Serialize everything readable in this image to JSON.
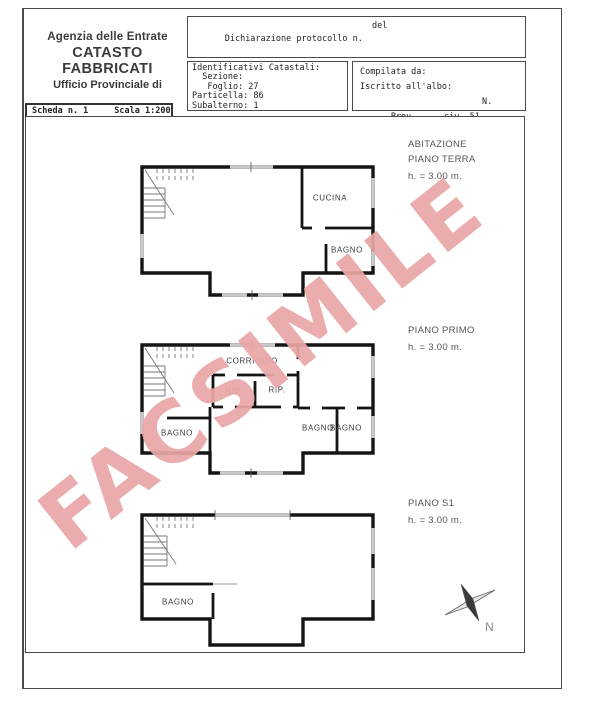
{
  "header": {
    "line1": "Agenzia delle Entrate",
    "line2": "CATASTO FABBRICATI",
    "line3": "Ufficio Provinciale di"
  },
  "protocol_box": {
    "declaration_label": "Dichiarazione protocollo n.",
    "del_label": "del",
    "planimetria_label": "Planimetria di u.i.u. in Comune di",
    "street": "Via Voghera",
    "civic": "civ. 51"
  },
  "cadastral_box": {
    "title": "Identificativi Catastali:",
    "rows": [
      "  Sezione:",
      "   Foglio: 27",
      "Particella: 86",
      "Subalterno: 1"
    ]
  },
  "compiler_box": {
    "compiled_by": "Compilata da:",
    "registered": "Iscritto all'albo:",
    "prov": "Prov.",
    "n": "N."
  },
  "sheet_box": {
    "sheet": "Scheda n. 1",
    "scale": "Scala 1:200"
  },
  "plans": {
    "terra": {
      "title": "ABITAZIONE",
      "subtitle": "PIANO TERRA",
      "height": "h. = 3.00 m.",
      "rooms": {
        "cucina": "CUCINA",
        "bagno": "BAGNO"
      }
    },
    "primo": {
      "title": "PIANO PRIMO",
      "height": "h. = 3.00 m.",
      "rooms": {
        "corridoio": "CORRIDOIO",
        "rip1": "RIP.",
        "rip2": "RIP.",
        "bagno1": "BAGNO",
        "bagno2": "BAGNO",
        "bagno3": "BAGNO"
      }
    },
    "s1": {
      "title": "PIANO S1",
      "height": "h. = 3.00 m.",
      "rooms": {
        "bagno": "BAGNO"
      }
    }
  },
  "compass": {
    "label": "N"
  },
  "watermark": {
    "text": "FACSIMILE",
    "color": "#e9a6a6"
  }
}
